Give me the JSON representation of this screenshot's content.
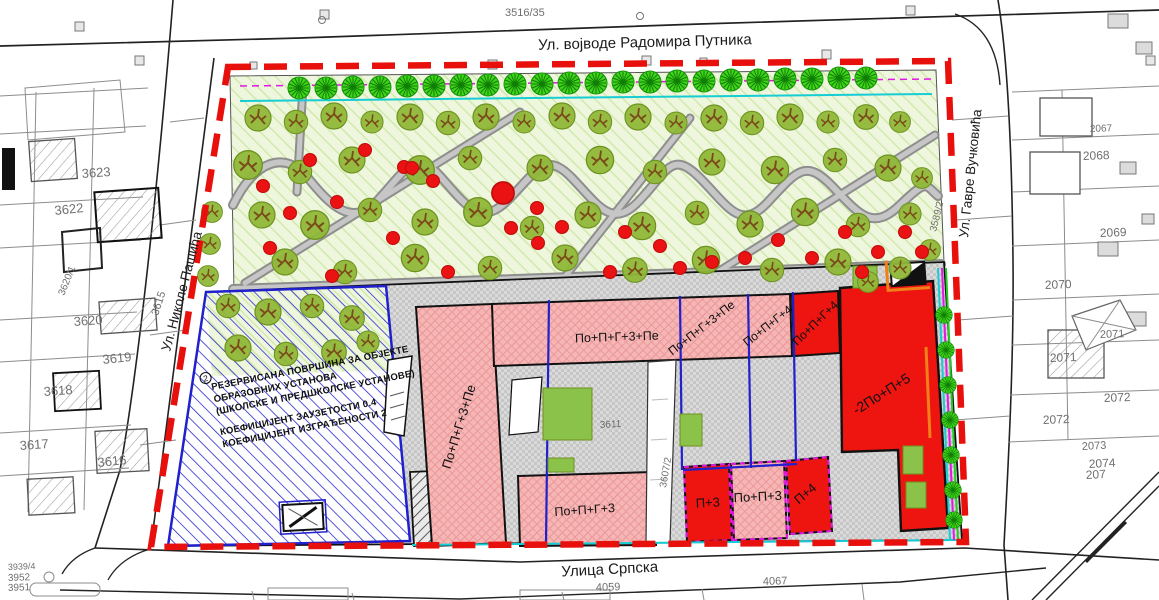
{
  "streets": {
    "top": "Ул. војводе Радомира Путника",
    "left": "Ул. Николе Пашића",
    "right": "Ул. Гавре Вучковића",
    "bottom": "Улица Српска"
  },
  "zone_note": {
    "marker": "2",
    "lines": [
      "РЕЗЕРВИСАНА ПОВРШИНА ЗА ОБЈЕКТЕ",
      "ОБРАЗОВНИХ УСТАНОВА",
      "(ШКОЛСКЕ И ПРЕДШКОЛСКЕ УСТАНОВЕ)",
      "КОЕФИЦИЈЕНТ ЗАУЗЕТОСТИ 0.4",
      "КОЕФИЦИЈЕНТ ИЗГРАЂЕНОСТИ 2"
    ]
  },
  "building_labels": [
    {
      "text": "По+П+Г+3+Пе",
      "x": 463,
      "y": 428,
      "rot": -73,
      "size": 13
    },
    {
      "text": "По+П+Г+3+Пе",
      "x": 617,
      "y": 341,
      "rot": -2,
      "size": 12.5
    },
    {
      "text": "По+П+Г+3+Пе",
      "x": 704,
      "y": 331,
      "rot": -38,
      "size": 12
    },
    {
      "text": "По+П+Г+4",
      "x": 770,
      "y": 329,
      "rot": -38,
      "size": 12
    },
    {
      "text": "По+П+Г+4",
      "x": 818,
      "y": 326,
      "rot": -44,
      "size": 12
    },
    {
      "text": "-2По+П+5",
      "x": 884,
      "y": 398,
      "rot": -32,
      "size": 14
    },
    {
      "text": "По+П+Г+3",
      "x": 585,
      "y": 514,
      "rot": -4,
      "size": 12.5
    },
    {
      "text": "П+3",
      "x": 708,
      "y": 507,
      "rot": -3,
      "size": 13
    },
    {
      "text": "По+П+3",
      "x": 758,
      "y": 501,
      "rot": -3,
      "size": 13
    },
    {
      "text": "П+4",
      "x": 808,
      "y": 497,
      "rot": -40,
      "size": 13
    }
  ],
  "parcels": [
    {
      "text": "3516/35",
      "x": 505,
      "y": 16,
      "rot": 0,
      "size": 11
    },
    {
      "text": "3623",
      "x": 82,
      "y": 178,
      "rot": -4,
      "size": 13
    },
    {
      "text": "3622",
      "x": 55,
      "y": 215,
      "rot": -6,
      "size": 13
    },
    {
      "text": "3620/1",
      "x": 64,
      "y": 296,
      "rot": -68,
      "size": 10
    },
    {
      "text": "3620",
      "x": 74,
      "y": 326,
      "rot": -4,
      "size": 13
    },
    {
      "text": "3619",
      "x": 103,
      "y": 364,
      "rot": -6,
      "size": 13
    },
    {
      "text": "3618",
      "x": 44,
      "y": 396,
      "rot": -4,
      "size": 13
    },
    {
      "text": "3617",
      "x": 20,
      "y": 450,
      "rot": -4,
      "size": 13
    },
    {
      "text": "3616",
      "x": 98,
      "y": 467,
      "rot": -6,
      "size": 13
    },
    {
      "text": "3939/4",
      "x": 8,
      "y": 570,
      "rot": -2,
      "size": 9
    },
    {
      "text": "3952",
      "x": 8,
      "y": 581,
      "rot": -2,
      "size": 10
    },
    {
      "text": "3951",
      "x": 8,
      "y": 591,
      "rot": -2,
      "size": 10
    },
    {
      "text": "3615",
      "x": 158,
      "y": 316,
      "rot": -72,
      "size": 11
    },
    {
      "text": "3589/2",
      "x": 936,
      "y": 232,
      "rot": -76,
      "size": 10
    },
    {
      "text": "4059",
      "x": 596,
      "y": 591,
      "rot": -2,
      "size": 11
    },
    {
      "text": "4067",
      "x": 763,
      "y": 585,
      "rot": -2,
      "size": 11
    },
    {
      "text": "2067",
      "x": 1090,
      "y": 132,
      "rot": -2,
      "size": 10
    },
    {
      "text": "2068",
      "x": 1083,
      "y": 160,
      "rot": -2,
      "size": 12
    },
    {
      "text": "2069",
      "x": 1100,
      "y": 237,
      "rot": -2,
      "size": 12
    },
    {
      "text": "2070",
      "x": 1045,
      "y": 289,
      "rot": -2,
      "size": 12
    },
    {
      "text": "2071",
      "x": 1100,
      "y": 338,
      "rot": -2,
      "size": 11
    },
    {
      "text": "2071",
      "x": 1050,
      "y": 362,
      "rot": -2,
      "size": 12
    },
    {
      "text": "2072",
      "x": 1104,
      "y": 402,
      "rot": -2,
      "size": 12
    },
    {
      "text": "2072",
      "x": 1043,
      "y": 424,
      "rot": -2,
      "size": 12
    },
    {
      "text": "2073",
      "x": 1082,
      "y": 450,
      "rot": -3,
      "size": 11
    },
    {
      "text": "2074",
      "x": 1089,
      "y": 468,
      "rot": -3,
      "size": 12
    },
    {
      "text": "207",
      "x": 1086,
      "y": 479,
      "rot": -3,
      "size": 12
    },
    {
      "text": "3607/2",
      "x": 666,
      "y": 488,
      "rot": -80,
      "size": 10
    },
    {
      "text": "3611",
      "x": 600,
      "y": 428,
      "rot": -3,
      "size": 10
    }
  ],
  "colors": {
    "plan_boundary": "#e8100c",
    "parcel_division": "#2020cc",
    "new_building": "#ee1511",
    "planned_building": "#f5b2b2",
    "school_zone_hatch": "#2a2ad0",
    "park_green": "#edf7dc",
    "street_tree_green": "#41d41b",
    "utility_cyan": "#17cdd4",
    "utility_magenta": "#e318e3",
    "utility_orange": "#f08019"
  },
  "map_features": {
    "park_trees": [
      [
        258,
        118,
        1
      ],
      [
        296,
        122,
        0.9
      ],
      [
        334,
        116,
        1
      ],
      [
        372,
        122,
        0.85
      ],
      [
        410,
        117,
        1
      ],
      [
        448,
        123,
        0.9
      ],
      [
        486,
        117,
        1
      ],
      [
        524,
        122,
        0.85
      ],
      [
        562,
        116,
        1
      ],
      [
        600,
        122,
        0.9
      ],
      [
        638,
        117,
        1
      ],
      [
        676,
        123,
        0.85
      ],
      [
        714,
        118,
        1
      ],
      [
        752,
        123,
        0.9
      ],
      [
        790,
        117,
        1
      ],
      [
        828,
        122,
        0.85
      ],
      [
        866,
        117,
        0.95
      ],
      [
        900,
        122,
        0.8
      ],
      [
        248,
        165,
        1.1
      ],
      [
        300,
        172,
        0.9
      ],
      [
        352,
        160,
        1
      ],
      [
        420,
        170,
        1.1
      ],
      [
        470,
        158,
        0.9
      ],
      [
        540,
        168,
        1
      ],
      [
        600,
        160,
        1.05
      ],
      [
        655,
        172,
        0.9
      ],
      [
        712,
        162,
        1
      ],
      [
        775,
        170,
        1.05
      ],
      [
        835,
        160,
        0.9
      ],
      [
        888,
        168,
        1
      ],
      [
        922,
        178,
        0.8
      ],
      [
        262,
        215,
        1
      ],
      [
        315,
        225,
        1.1
      ],
      [
        370,
        210,
        0.9
      ],
      [
        425,
        222,
        1
      ],
      [
        478,
        212,
        1.1
      ],
      [
        532,
        228,
        0.9
      ],
      [
        588,
        215,
        1
      ],
      [
        642,
        226,
        1.05
      ],
      [
        697,
        213,
        0.9
      ],
      [
        750,
        224,
        1
      ],
      [
        805,
        212,
        1.05
      ],
      [
        858,
        225,
        0.9
      ],
      [
        910,
        214,
        0.85
      ],
      [
        285,
        262,
        1
      ],
      [
        345,
        272,
        0.9
      ],
      [
        415,
        258,
        1.05
      ],
      [
        490,
        268,
        0.9
      ],
      [
        565,
        258,
        1
      ],
      [
        635,
        270,
        0.95
      ],
      [
        706,
        260,
        1.05
      ],
      [
        772,
        270,
        0.9
      ],
      [
        838,
        262,
        1
      ],
      [
        900,
        268,
        0.85
      ],
      [
        228,
        306,
        0.9
      ],
      [
        268,
        312,
        1
      ],
      [
        312,
        306,
        0.9
      ],
      [
        352,
        318,
        0.95
      ],
      [
        238,
        348,
        1
      ],
      [
        286,
        354,
        0.9
      ],
      [
        334,
        352,
        0.95
      ],
      [
        368,
        342,
        0.85
      ],
      [
        212,
        212,
        0.8
      ],
      [
        210,
        244,
        0.8
      ],
      [
        208,
        276,
        0.8
      ],
      [
        868,
        282,
        0.8
      ],
      [
        930,
        250,
        0.8
      ]
    ],
    "red_dots": [
      [
        263,
        186,
        1
      ],
      [
        290,
        213,
        1
      ],
      [
        337,
        202,
        1
      ],
      [
        270,
        248,
        1
      ],
      [
        332,
        276,
        1
      ],
      [
        393,
        238,
        1
      ],
      [
        448,
        272,
        1
      ],
      [
        404,
        167,
        1
      ],
      [
        365,
        150,
        1
      ],
      [
        433,
        181,
        1
      ],
      [
        412,
        168,
        1
      ],
      [
        503,
        193,
        1.7
      ],
      [
        537,
        208,
        1
      ],
      [
        562,
        227,
        1
      ],
      [
        511,
        228,
        1
      ],
      [
        538,
        243,
        1
      ],
      [
        610,
        272,
        1
      ],
      [
        660,
        246,
        1
      ],
      [
        680,
        268,
        1
      ],
      [
        625,
        232,
        1
      ],
      [
        712,
        262,
        1
      ],
      [
        745,
        258,
        1
      ],
      [
        778,
        240,
        1
      ],
      [
        812,
        258,
        1
      ],
      [
        845,
        232,
        1
      ],
      [
        878,
        252,
        1
      ],
      [
        905,
        232,
        1
      ],
      [
        862,
        272,
        1
      ],
      [
        922,
        252,
        1
      ],
      [
        310,
        160,
        1
      ]
    ],
    "street_trees_top": [
      [
        299,
        88,
        1
      ],
      [
        326,
        88,
        1
      ],
      [
        353,
        87,
        1
      ],
      [
        380,
        87,
        1
      ],
      [
        407,
        86,
        1
      ],
      [
        434,
        86,
        1
      ],
      [
        461,
        85,
        1
      ],
      [
        488,
        85,
        1
      ],
      [
        515,
        84,
        1
      ],
      [
        542,
        84,
        1
      ],
      [
        569,
        83,
        1
      ],
      [
        596,
        83,
        1
      ],
      [
        623,
        82,
        1
      ],
      [
        650,
        82,
        1
      ],
      [
        677,
        81,
        1
      ],
      [
        704,
        81,
        1
      ],
      [
        731,
        80,
        1
      ],
      [
        758,
        80,
        1
      ],
      [
        785,
        79,
        1
      ],
      [
        812,
        79,
        1
      ],
      [
        839,
        78,
        1
      ],
      [
        866,
        78,
        1
      ]
    ],
    "street_trees_right": [
      [
        944,
        315,
        0.75
      ],
      [
        946,
        350,
        0.75
      ],
      [
        948,
        385,
        0.75
      ],
      [
        950,
        420,
        0.75
      ],
      [
        951,
        455,
        0.75
      ],
      [
        953,
        490,
        0.75
      ],
      [
        954,
        520,
        0.75
      ]
    ]
  }
}
